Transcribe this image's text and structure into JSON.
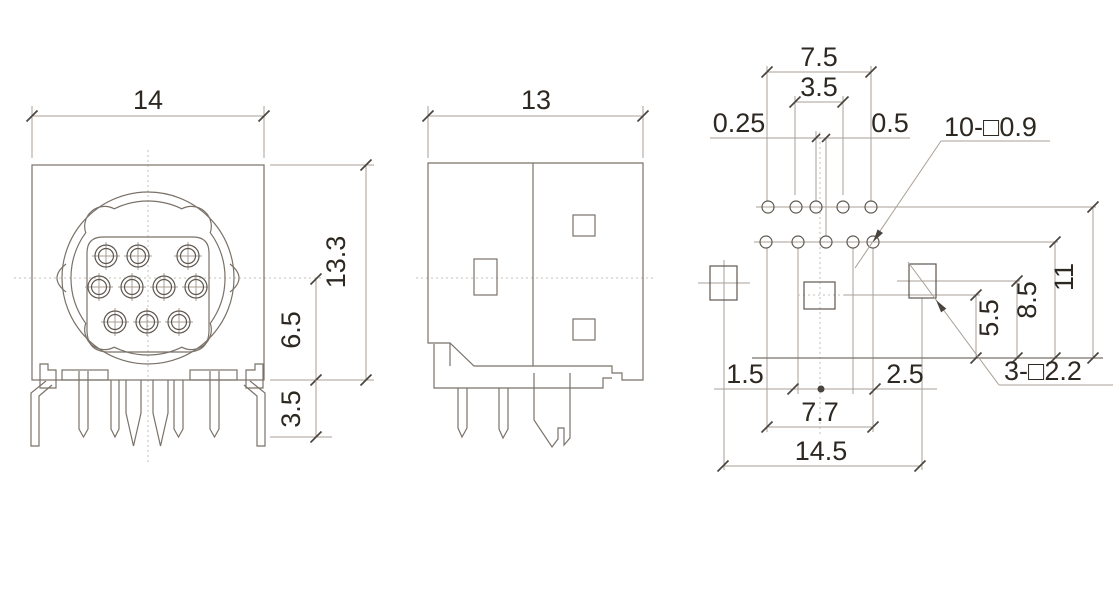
{
  "views": {
    "front": {
      "dim_width": "14",
      "dim_height": "13.3",
      "dim_center_to_base": "6.5",
      "dim_pin_length": "3.5"
    },
    "side": {
      "dim_width": "13"
    },
    "footprint": {
      "dim_row_span": "7.5",
      "dim_row_inner": "3.5",
      "dim_row_offset_left": "0.25",
      "dim_row_offset_right": "0.5",
      "callout_pin_holes": "10-□0.9",
      "dim_height_row1": "11",
      "dim_height_row2": "8.5",
      "dim_height_mount": "5.5",
      "callout_mount_holes": "3-□2.2",
      "dim_base_left": "1.5",
      "dim_base_right": "2.5",
      "dim_row_span_lower": "7.7",
      "dim_total_width": "14.5"
    }
  }
}
